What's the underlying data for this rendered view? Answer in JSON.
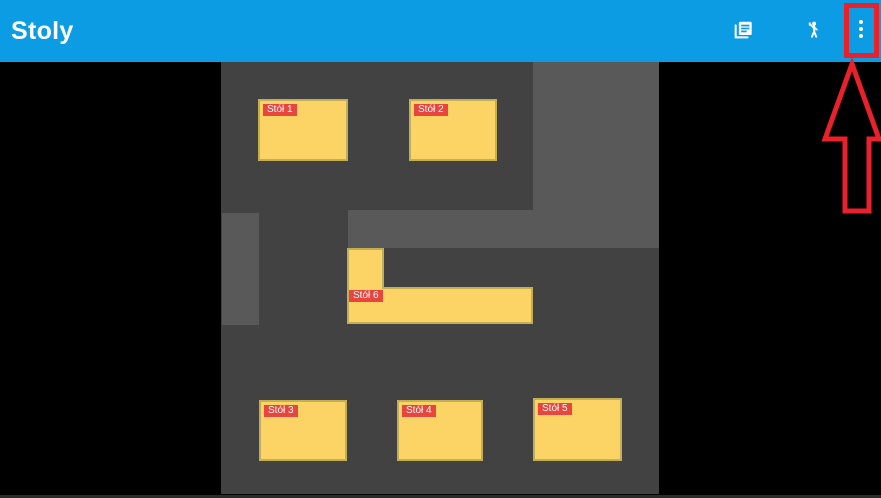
{
  "header": {
    "title": "Stoly",
    "actions": [
      {
        "name": "copy-pages-icon",
        "meaning": "duplicate / list of table layouts"
      },
      {
        "name": "person-greeting-icon",
        "meaning": "waiter / call person"
      },
      {
        "name": "overflow-menu-icon",
        "meaning": "more options (three vertical dots)"
      }
    ]
  },
  "floorplan": {
    "tables": [
      {
        "id": 1,
        "label": "Stół 1"
      },
      {
        "id": 2,
        "label": "Stół 2"
      },
      {
        "id": 3,
        "label": "Stół 3"
      },
      {
        "id": 4,
        "label": "Stół 4"
      },
      {
        "id": 5,
        "label": "Stół 5"
      },
      {
        "id": 6,
        "label": "Stół 6"
      }
    ]
  },
  "annotation": {
    "type": "red-box-and-up-arrow",
    "target": "overflow-menu-button"
  },
  "colors": {
    "header_bg": "#0C9CE4",
    "side_bg": "#000000",
    "plan_bg": "#424242",
    "zone_fill": "#595959",
    "table_fill": "#FBD465",
    "table_border": "#C2AE55",
    "label_bg": "#E8453F",
    "label_text": "#FFFFFF",
    "annotation": "#E8212B"
  }
}
